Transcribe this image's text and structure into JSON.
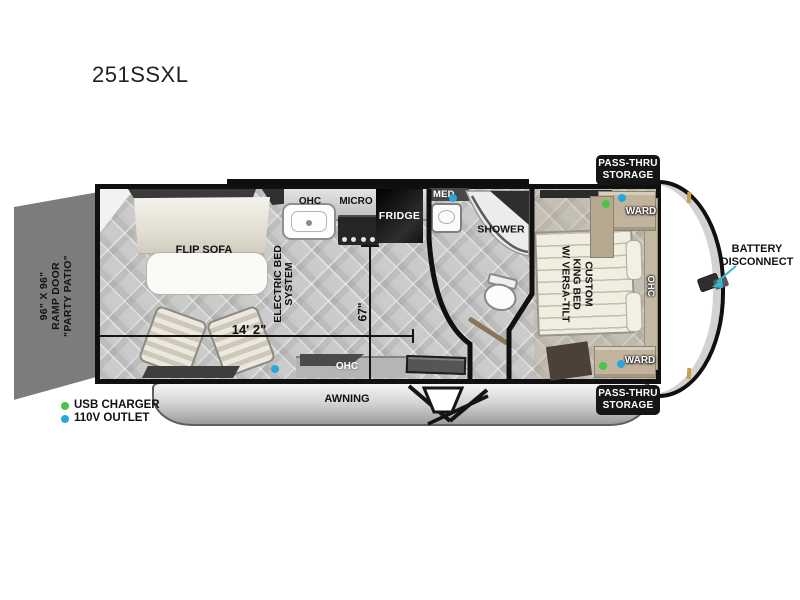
{
  "model": "251SSXL",
  "ramp_door": {
    "line1": "96\" X 96\"",
    "line2": "RAMP DOOR",
    "line3": "\"PARTY PATIO\""
  },
  "living": {
    "sofa": "FLIP SOFA",
    "bed_system_line1": "ELECTRIC BED",
    "bed_system_line2": "SYSTEM"
  },
  "kitchen": {
    "ohc": "OHC",
    "micro": "MICRO",
    "fridge": "FRIDGE"
  },
  "bath": {
    "med": "MED",
    "shower": "SHOWER"
  },
  "bedroom": {
    "bed_line1": "CUSTOM",
    "bed_line2": "KING BED",
    "bed_line3": "W/ VERSA-TILT",
    "ohc": "OHC",
    "ward_rear": "WARD",
    "ward_front": "WARD"
  },
  "entry": {
    "ohc": "OHC"
  },
  "exterior": {
    "awning": "AWNING",
    "pass_thru_line1": "PASS-THRU",
    "pass_thru_line2": "STORAGE",
    "battery_line1": "BATTERY",
    "battery_line2": "DISCONNECT"
  },
  "dimensions": {
    "length": "14' 2\"",
    "width": "67\""
  },
  "legend": {
    "usb": "USB CHARGER",
    "outlet": "110V OUTLET"
  },
  "colors": {
    "wall": "#101010",
    "usb_green": "#4bc44b",
    "outlet_blue": "#2aa6dc",
    "ramp_gray": "#7c7c7c",
    "arrow_cyan": "#35b8cf",
    "badge_black": "#161616"
  }
}
